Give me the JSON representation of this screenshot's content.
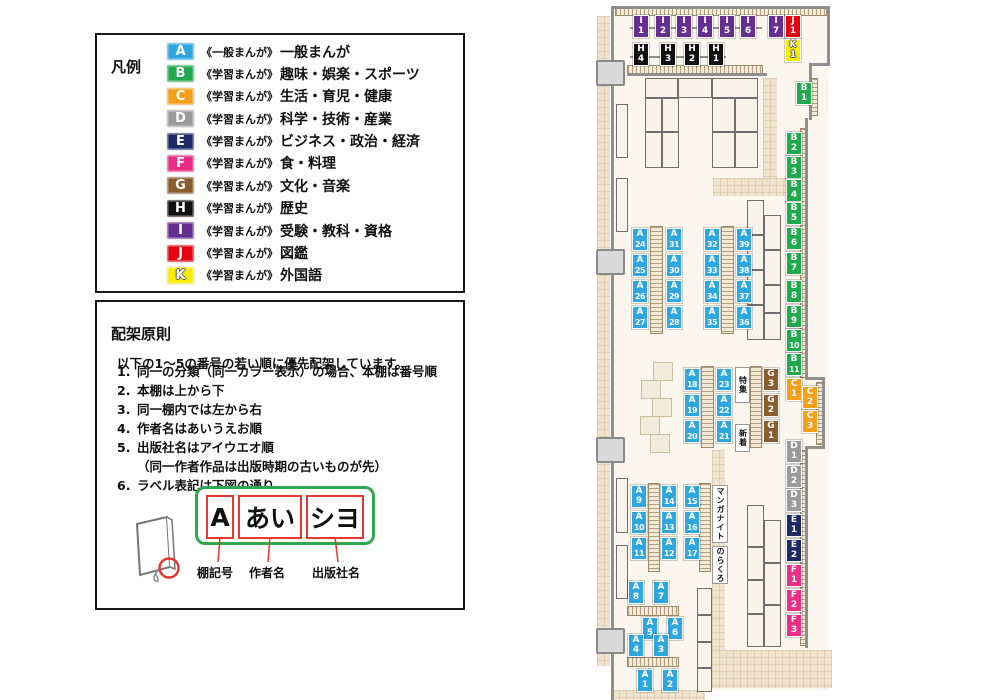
{
  "legend": {
    "title": "凡例",
    "items": [
      {
        "code": "A",
        "color": "#2EA7E0",
        "prefix": "《一般まんが》",
        "label": "一般まんが"
      },
      {
        "code": "B",
        "color": "#21A94D",
        "prefix": "《学習まんが》",
        "label": "趣味・娯楽・スポーツ"
      },
      {
        "code": "C",
        "color": "#F6A019",
        "prefix": "《学習まんが》",
        "label": "生活・育児・健康"
      },
      {
        "code": "D",
        "color": "#9B9B9C",
        "prefix": "《学習まんが》",
        "label": "科学・技術・産業"
      },
      {
        "code": "E",
        "color": "#1C2B66",
        "prefix": "《学習まんが》",
        "label": "ビジネス・政治・経済"
      },
      {
        "code": "F",
        "color": "#EB2D87",
        "prefix": "《学習まんが》",
        "label": "食・料理"
      },
      {
        "code": "G",
        "color": "#8A5C2E",
        "prefix": "《学習まんが》",
        "label": "文化・音楽"
      },
      {
        "code": "H",
        "color": "#111111",
        "prefix": "《学習まんが》",
        "label": "歴史"
      },
      {
        "code": "I",
        "color": "#672E92",
        "prefix": "《学習まんが》",
        "label": "受験・教科・資格"
      },
      {
        "code": "J",
        "color": "#E60012",
        "prefix": "《学習まんが》",
        "label": "図鑑"
      },
      {
        "code": "K",
        "color": "#F8EC00",
        "prefix": "《学習まんが》",
        "label": "外国語",
        "outlined": true
      }
    ]
  },
  "principles": {
    "title": "配架原則",
    "intro": "以下の1〜5の番号の若い順に優先配架しています。",
    "rules": [
      {
        "num": "1.",
        "text": "同一の分類（同一カラー表示）の場合、本棚は番号順"
      },
      {
        "num": "2.",
        "text": "本棚は上から下"
      },
      {
        "num": "3.",
        "text": "同一棚内では左から右"
      },
      {
        "num": "4.",
        "text": "作者名はあいうえお順"
      },
      {
        "num": "5.",
        "text": "出版社名はアイウエオ順"
      },
      {
        "num": "",
        "text": "（同一作者作品は出版時期の古いものが先）",
        "indent": true
      },
      {
        "num": "6.",
        "text": "ラベル表記は下図の通り"
      }
    ],
    "diagram": {
      "segments": [
        "A",
        "あい",
        "シヨ"
      ],
      "captions": [
        "棚記号",
        "作者名",
        "出版社名"
      ]
    }
  },
  "map": {
    "category_colors": {
      "A": "#2EA7E0",
      "B": "#21A94D",
      "C": "#F6A019",
      "D": "#9B9B9C",
      "E": "#1C2B66",
      "F": "#EB2D87",
      "G": "#8A5C2E",
      "H": "#111111",
      "I": "#672E92",
      "J": "#E60012",
      "K": "#F8EC00"
    },
    "signs": [
      {
        "text": "特集",
        "x": 735,
        "y": 367,
        "w": 15,
        "h": 36
      },
      {
        "text": "新着",
        "x": 735,
        "y": 424,
        "w": 15,
        "h": 28
      },
      {
        "text": "マンガナイト",
        "x": 712,
        "y": 485,
        "w": 16,
        "h": 58
      },
      {
        "text": "のらくろ",
        "x": 712,
        "y": 546,
        "w": 16,
        "h": 38
      }
    ],
    "shelf_labels": [
      {
        "id": "I1",
        "x": 633,
        "y": 15
      },
      {
        "id": "I2",
        "x": 655,
        "y": 15
      },
      {
        "id": "I3",
        "x": 676,
        "y": 15
      },
      {
        "id": "I4",
        "x": 697,
        "y": 15
      },
      {
        "id": "I5",
        "x": 719,
        "y": 15
      },
      {
        "id": "I6",
        "x": 740,
        "y": 15
      },
      {
        "id": "I7",
        "x": 768,
        "y": 15
      },
      {
        "id": "J1",
        "x": 785,
        "y": 15
      },
      {
        "id": "K1",
        "x": 785,
        "y": 39
      },
      {
        "id": "H4",
        "x": 633,
        "y": 43
      },
      {
        "id": "H3",
        "x": 660,
        "y": 43
      },
      {
        "id": "H2",
        "x": 684,
        "y": 43
      },
      {
        "id": "H1",
        "x": 708,
        "y": 43
      },
      {
        "id": "B1",
        "x": 796,
        "y": 82
      },
      {
        "id": "B2",
        "x": 786,
        "y": 132
      },
      {
        "id": "B3",
        "x": 786,
        "y": 156
      },
      {
        "id": "B4",
        "x": 786,
        "y": 179
      },
      {
        "id": "B5",
        "x": 786,
        "y": 202
      },
      {
        "id": "B6",
        "x": 786,
        "y": 227
      },
      {
        "id": "B7",
        "x": 786,
        "y": 252
      },
      {
        "id": "B8",
        "x": 786,
        "y": 280
      },
      {
        "id": "B9",
        "x": 786,
        "y": 305
      },
      {
        "id": "B10",
        "x": 786,
        "y": 329
      },
      {
        "id": "B11",
        "x": 786,
        "y": 353
      },
      {
        "id": "C1",
        "x": 786,
        "y": 378
      },
      {
        "id": "C2",
        "x": 802,
        "y": 386
      },
      {
        "id": "C3",
        "x": 802,
        "y": 410
      },
      {
        "id": "G3",
        "x": 763,
        "y": 368
      },
      {
        "id": "G2",
        "x": 763,
        "y": 394
      },
      {
        "id": "G1",
        "x": 763,
        "y": 420
      },
      {
        "id": "D1",
        "x": 786,
        "y": 440
      },
      {
        "id": "D2",
        "x": 786,
        "y": 465
      },
      {
        "id": "D3",
        "x": 786,
        "y": 489
      },
      {
        "id": "E1",
        "x": 786,
        "y": 514
      },
      {
        "id": "E2",
        "x": 786,
        "y": 539
      },
      {
        "id": "F1",
        "x": 786,
        "y": 564
      },
      {
        "id": "F2",
        "x": 786,
        "y": 589
      },
      {
        "id": "F3",
        "x": 786,
        "y": 614
      },
      {
        "id": "A24",
        "x": 632,
        "y": 228
      },
      {
        "id": "A25",
        "x": 632,
        "y": 254
      },
      {
        "id": "A26",
        "x": 632,
        "y": 280
      },
      {
        "id": "A27",
        "x": 632,
        "y": 306
      },
      {
        "id": "A31",
        "x": 666,
        "y": 228
      },
      {
        "id": "A30",
        "x": 666,
        "y": 254
      },
      {
        "id": "A29",
        "x": 666,
        "y": 280
      },
      {
        "id": "A28",
        "x": 666,
        "y": 306
      },
      {
        "id": "A32",
        "x": 704,
        "y": 228
      },
      {
        "id": "A33",
        "x": 704,
        "y": 254
      },
      {
        "id": "A34",
        "x": 704,
        "y": 280
      },
      {
        "id": "A35",
        "x": 704,
        "y": 306
      },
      {
        "id": "A39",
        "x": 736,
        "y": 228
      },
      {
        "id": "A38",
        "x": 736,
        "y": 254
      },
      {
        "id": "A37",
        "x": 736,
        "y": 280
      },
      {
        "id": "A36",
        "x": 736,
        "y": 306
      },
      {
        "id": "A18",
        "x": 684,
        "y": 368
      },
      {
        "id": "A19",
        "x": 684,
        "y": 394
      },
      {
        "id": "A20",
        "x": 684,
        "y": 420
      },
      {
        "id": "A23",
        "x": 716,
        "y": 368
      },
      {
        "id": "A22",
        "x": 716,
        "y": 394
      },
      {
        "id": "A21",
        "x": 716,
        "y": 420
      },
      {
        "id": "A9",
        "x": 631,
        "y": 485
      },
      {
        "id": "A10",
        "x": 631,
        "y": 511
      },
      {
        "id": "A11",
        "x": 631,
        "y": 537
      },
      {
        "id": "A14",
        "x": 661,
        "y": 485
      },
      {
        "id": "A13",
        "x": 661,
        "y": 511
      },
      {
        "id": "A12",
        "x": 661,
        "y": 537
      },
      {
        "id": "A15",
        "x": 684,
        "y": 485
      },
      {
        "id": "A16",
        "x": 684,
        "y": 511
      },
      {
        "id": "A17",
        "x": 684,
        "y": 537
      },
      {
        "id": "A8",
        "x": 628,
        "y": 581
      },
      {
        "id": "A7",
        "x": 653,
        "y": 581
      },
      {
        "id": "A5",
        "x": 642,
        "y": 617
      },
      {
        "id": "A6",
        "x": 667,
        "y": 617
      },
      {
        "id": "A4",
        "x": 628,
        "y": 634
      },
      {
        "id": "A3",
        "x": 653,
        "y": 634
      },
      {
        "id": "A1",
        "x": 637,
        "y": 669
      },
      {
        "id": "A2",
        "x": 662,
        "y": 669
      }
    ]
  }
}
